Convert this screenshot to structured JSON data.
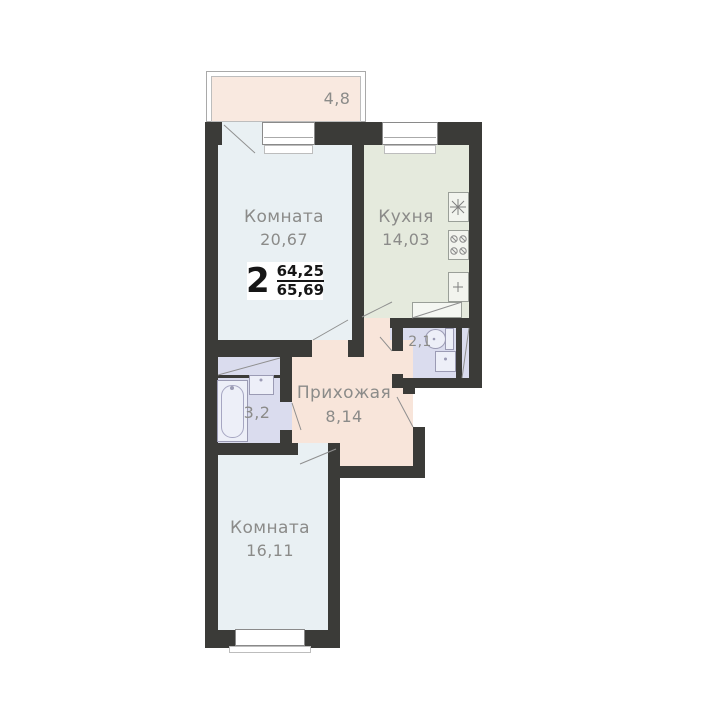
{
  "badge": {
    "rooms_count": "2",
    "area_numerator": "64,25",
    "area_denominator": "65,69"
  },
  "rooms": {
    "balcony": {
      "area": "4,8"
    },
    "living_room": {
      "name": "Комната",
      "area": "20,67"
    },
    "kitchen": {
      "name": "Кухня",
      "area": "14,03"
    },
    "wc": {
      "area": "2,1"
    },
    "hallway": {
      "name": "Прихожая",
      "area": "8,14"
    },
    "bathroom": {
      "area": "3,2"
    },
    "bedroom": {
      "name": "Комната",
      "area": "16,11"
    }
  },
  "icons": [
    "bathtub-icon",
    "toilet-icon",
    "washbasin-icon",
    "stove-icon",
    "kitchen-sink-icon",
    "fixture-plus-icon",
    "vent-shaft-icon",
    "door-swing-icon",
    "window-icon"
  ],
  "colors": {
    "wall": "#3b3b38",
    "room_fill": "#e9f0f3",
    "kitchen_fill": "#e5eadd",
    "bathroom_fill": "#dadcee",
    "hallway_fill": "#f8e5da",
    "balcony_fill": "#f9e9e0",
    "label_text": "#8b8b89",
    "badge_text": "#161616"
  }
}
